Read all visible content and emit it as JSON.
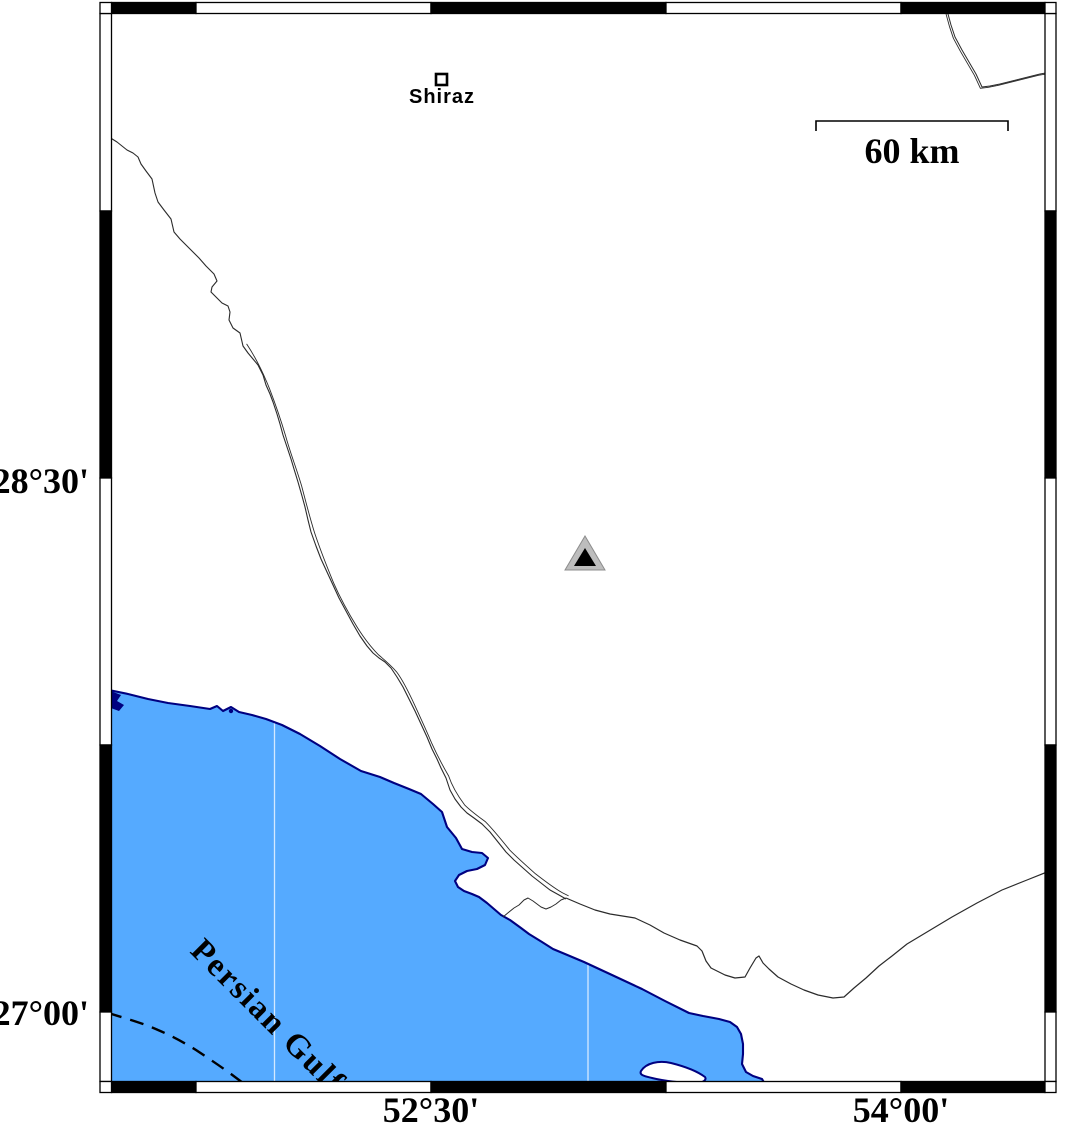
{
  "map": {
    "axes": {
      "left_labels": [
        "28°30'",
        "27°00'"
      ],
      "bottom_labels": [
        "52°30'",
        "54°00'"
      ]
    },
    "city": {
      "name": "Shiraz"
    },
    "scale_bar": {
      "label": "60 km"
    },
    "sea": {
      "label": "Persian Gulf"
    },
    "markers": {
      "station": "triangle-icon",
      "city": "square-icon"
    },
    "colors": {
      "sea_fill": "#55aaff",
      "coast_stroke": "#000080",
      "land": "#ffffff",
      "triangle_outer": "#bdbdbd",
      "triangle_inner": "#000000"
    }
  }
}
